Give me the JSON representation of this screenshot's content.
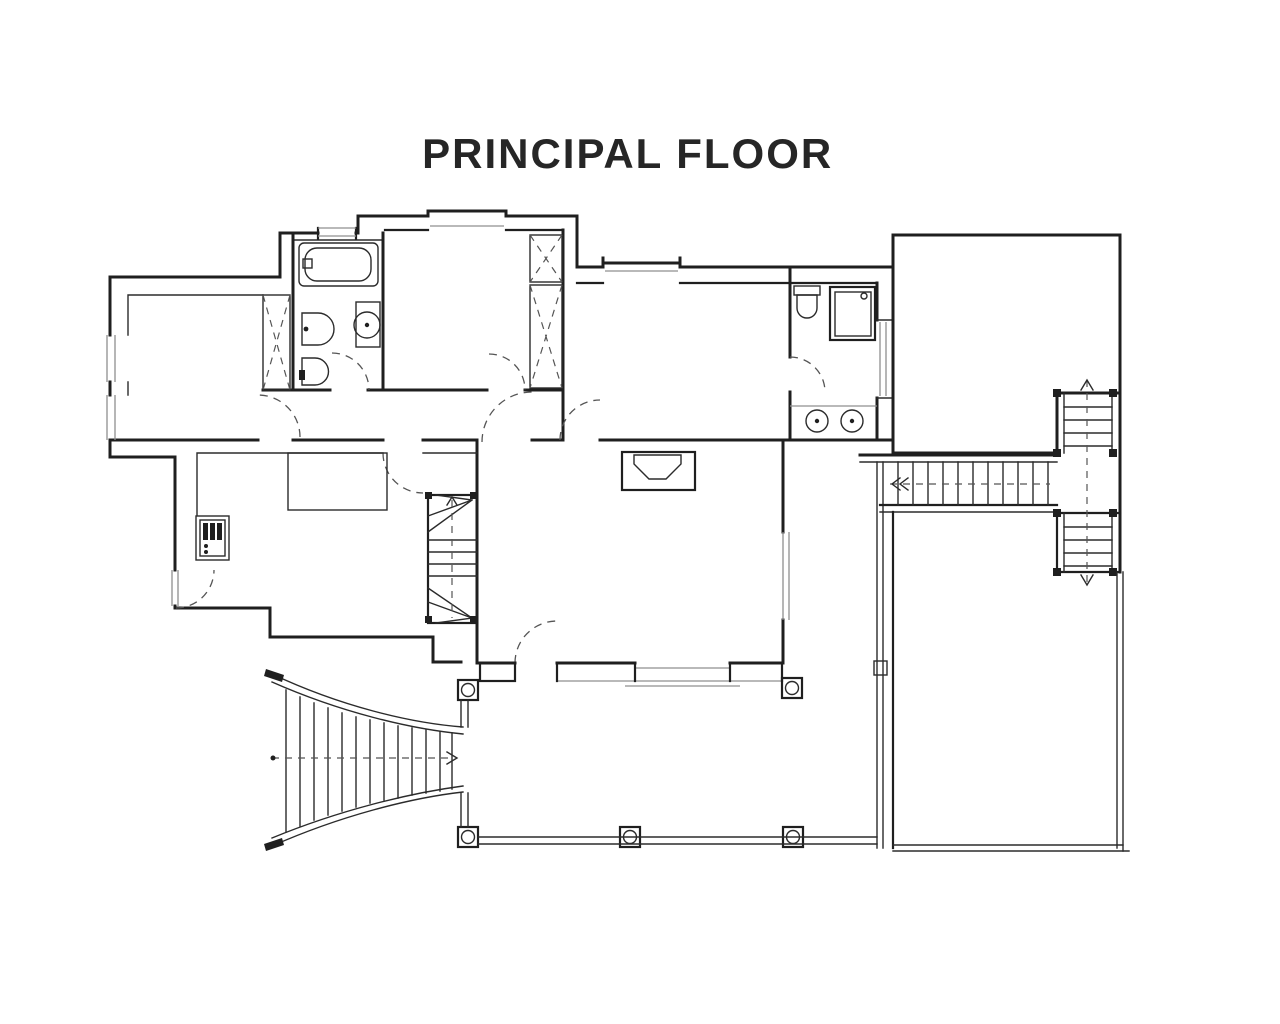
{
  "page": {
    "background": "#ffffff"
  },
  "header": {
    "title": "PRINCIPAL FLOOR"
  },
  "drawing": {
    "ink_color": "#1f1f1f",
    "window_color": "#8f8f8f",
    "door_swing_color": "#555555",
    "fixtures": [
      "bathtub",
      "bidet",
      "toilet",
      "pedestal-sink",
      "wc",
      "shower",
      "double-basins",
      "cooker",
      "kitchen-counter",
      "fireplace",
      "wardrobe-x3",
      "winder-staircase",
      "fan-staircase",
      "side-staircase",
      "landing-staircases",
      "porch-columns",
      "terrace-railing"
    ]
  }
}
